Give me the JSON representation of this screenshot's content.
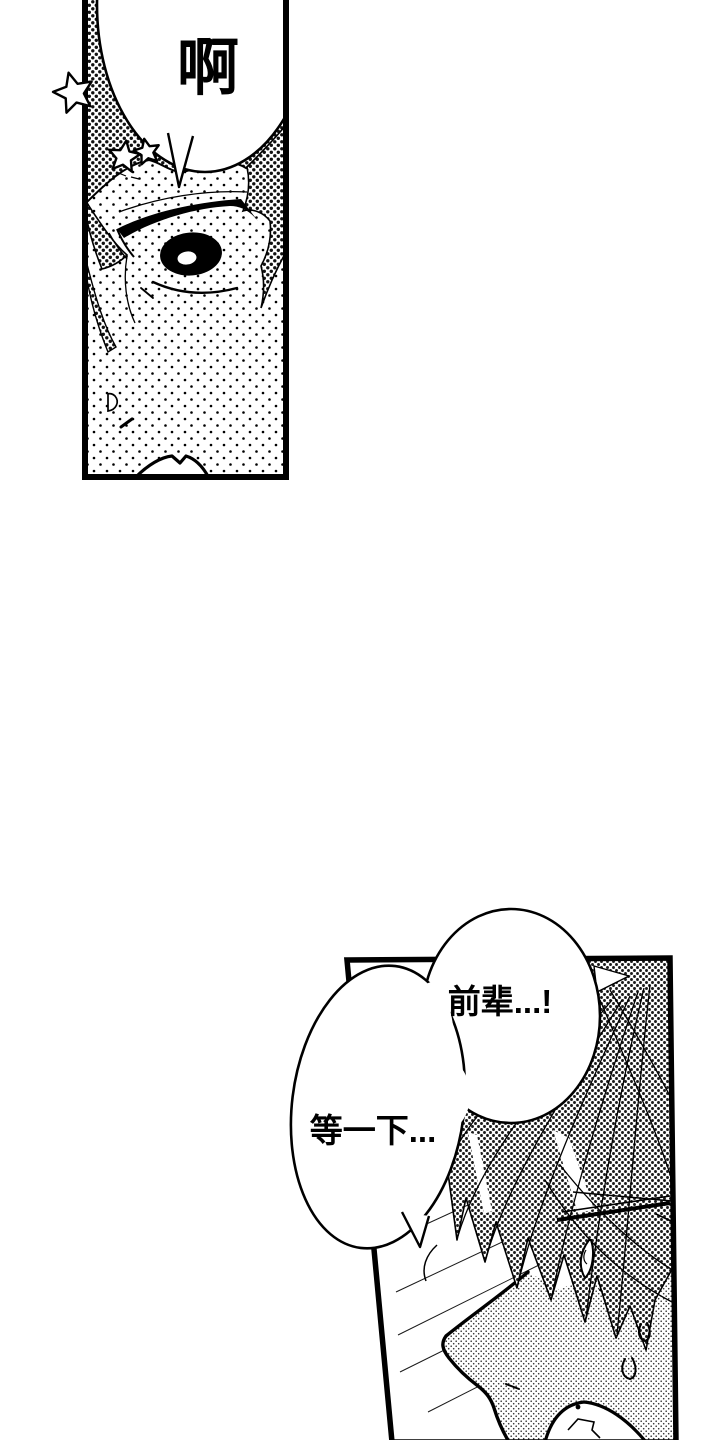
{
  "page": {
    "type": "manga-page",
    "background": "#ffffff",
    "ink": "#000000",
    "panel_count": 2
  },
  "panels": [
    {
      "name": "top-panel",
      "subject": "close-up-eye",
      "bubbles": [
        {
          "text": "啊"
        }
      ],
      "decorations": [
        "star",
        "star",
        "star"
      ]
    },
    {
      "name": "bottom-panel",
      "subject": "surprised-character-with-glasses",
      "bubbles": [
        {
          "text": "前辈...!"
        },
        {
          "text": "等一下..."
        }
      ],
      "decorations": [
        "sweat-drop",
        "sweat-drop"
      ]
    }
  ]
}
